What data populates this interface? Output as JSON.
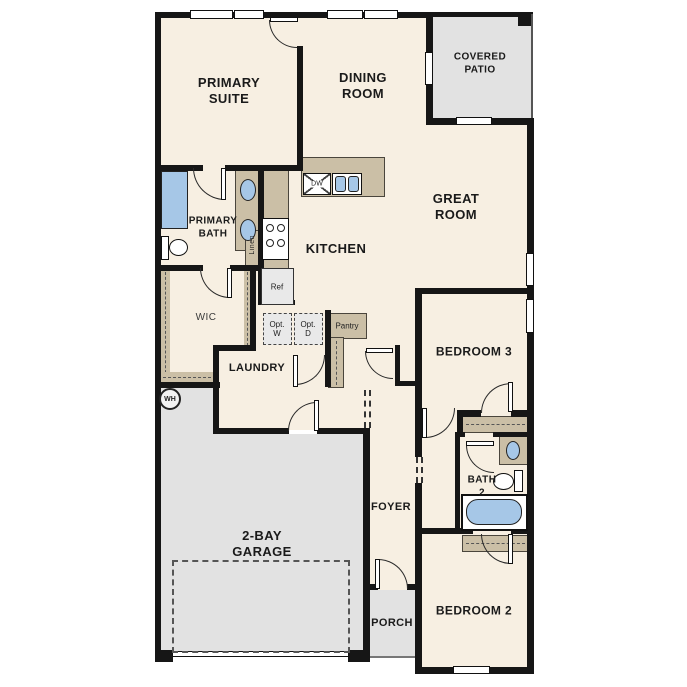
{
  "title": "Single-story home floor plan",
  "colors": {
    "wall": "#161616",
    "floor": "#f7efe2",
    "ext": "#e2e2e2",
    "tan": "#cbbfa6",
    "blue": "#a6c7e7",
    "appliance": "#e9e9e9"
  },
  "rooms": [
    {
      "id": "primary-suite",
      "label": "PRIMARY\nSUITE"
    },
    {
      "id": "dining-room",
      "label": "DINING\nROOM"
    },
    {
      "id": "covered-patio",
      "label": "COVERED\nPATIO"
    },
    {
      "id": "great-room",
      "label": "GREAT\nROOM"
    },
    {
      "id": "primary-bath",
      "label": "PRIMARY\nBATH"
    },
    {
      "id": "kitchen",
      "label": "KITCHEN"
    },
    {
      "id": "wic",
      "label": "WIC"
    },
    {
      "id": "laundry",
      "label": "LAUNDRY"
    },
    {
      "id": "bedroom-3",
      "label": "BEDROOM 3"
    },
    {
      "id": "bath-2",
      "label": "BATH\n2"
    },
    {
      "id": "foyer",
      "label": "FOYER"
    },
    {
      "id": "garage",
      "label": "2-BAY\nGARAGE"
    },
    {
      "id": "porch",
      "label": "PORCH"
    },
    {
      "id": "bedroom-2",
      "label": "BEDROOM 2"
    }
  ],
  "fixtures": {
    "dishwasher": "DW",
    "refrigerator": "Ref",
    "optional_washer": "Opt.\nW",
    "optional_dryer": "Opt.\nD",
    "pantry": "Pantry",
    "linen": "Linen",
    "water_heater": "WH"
  }
}
